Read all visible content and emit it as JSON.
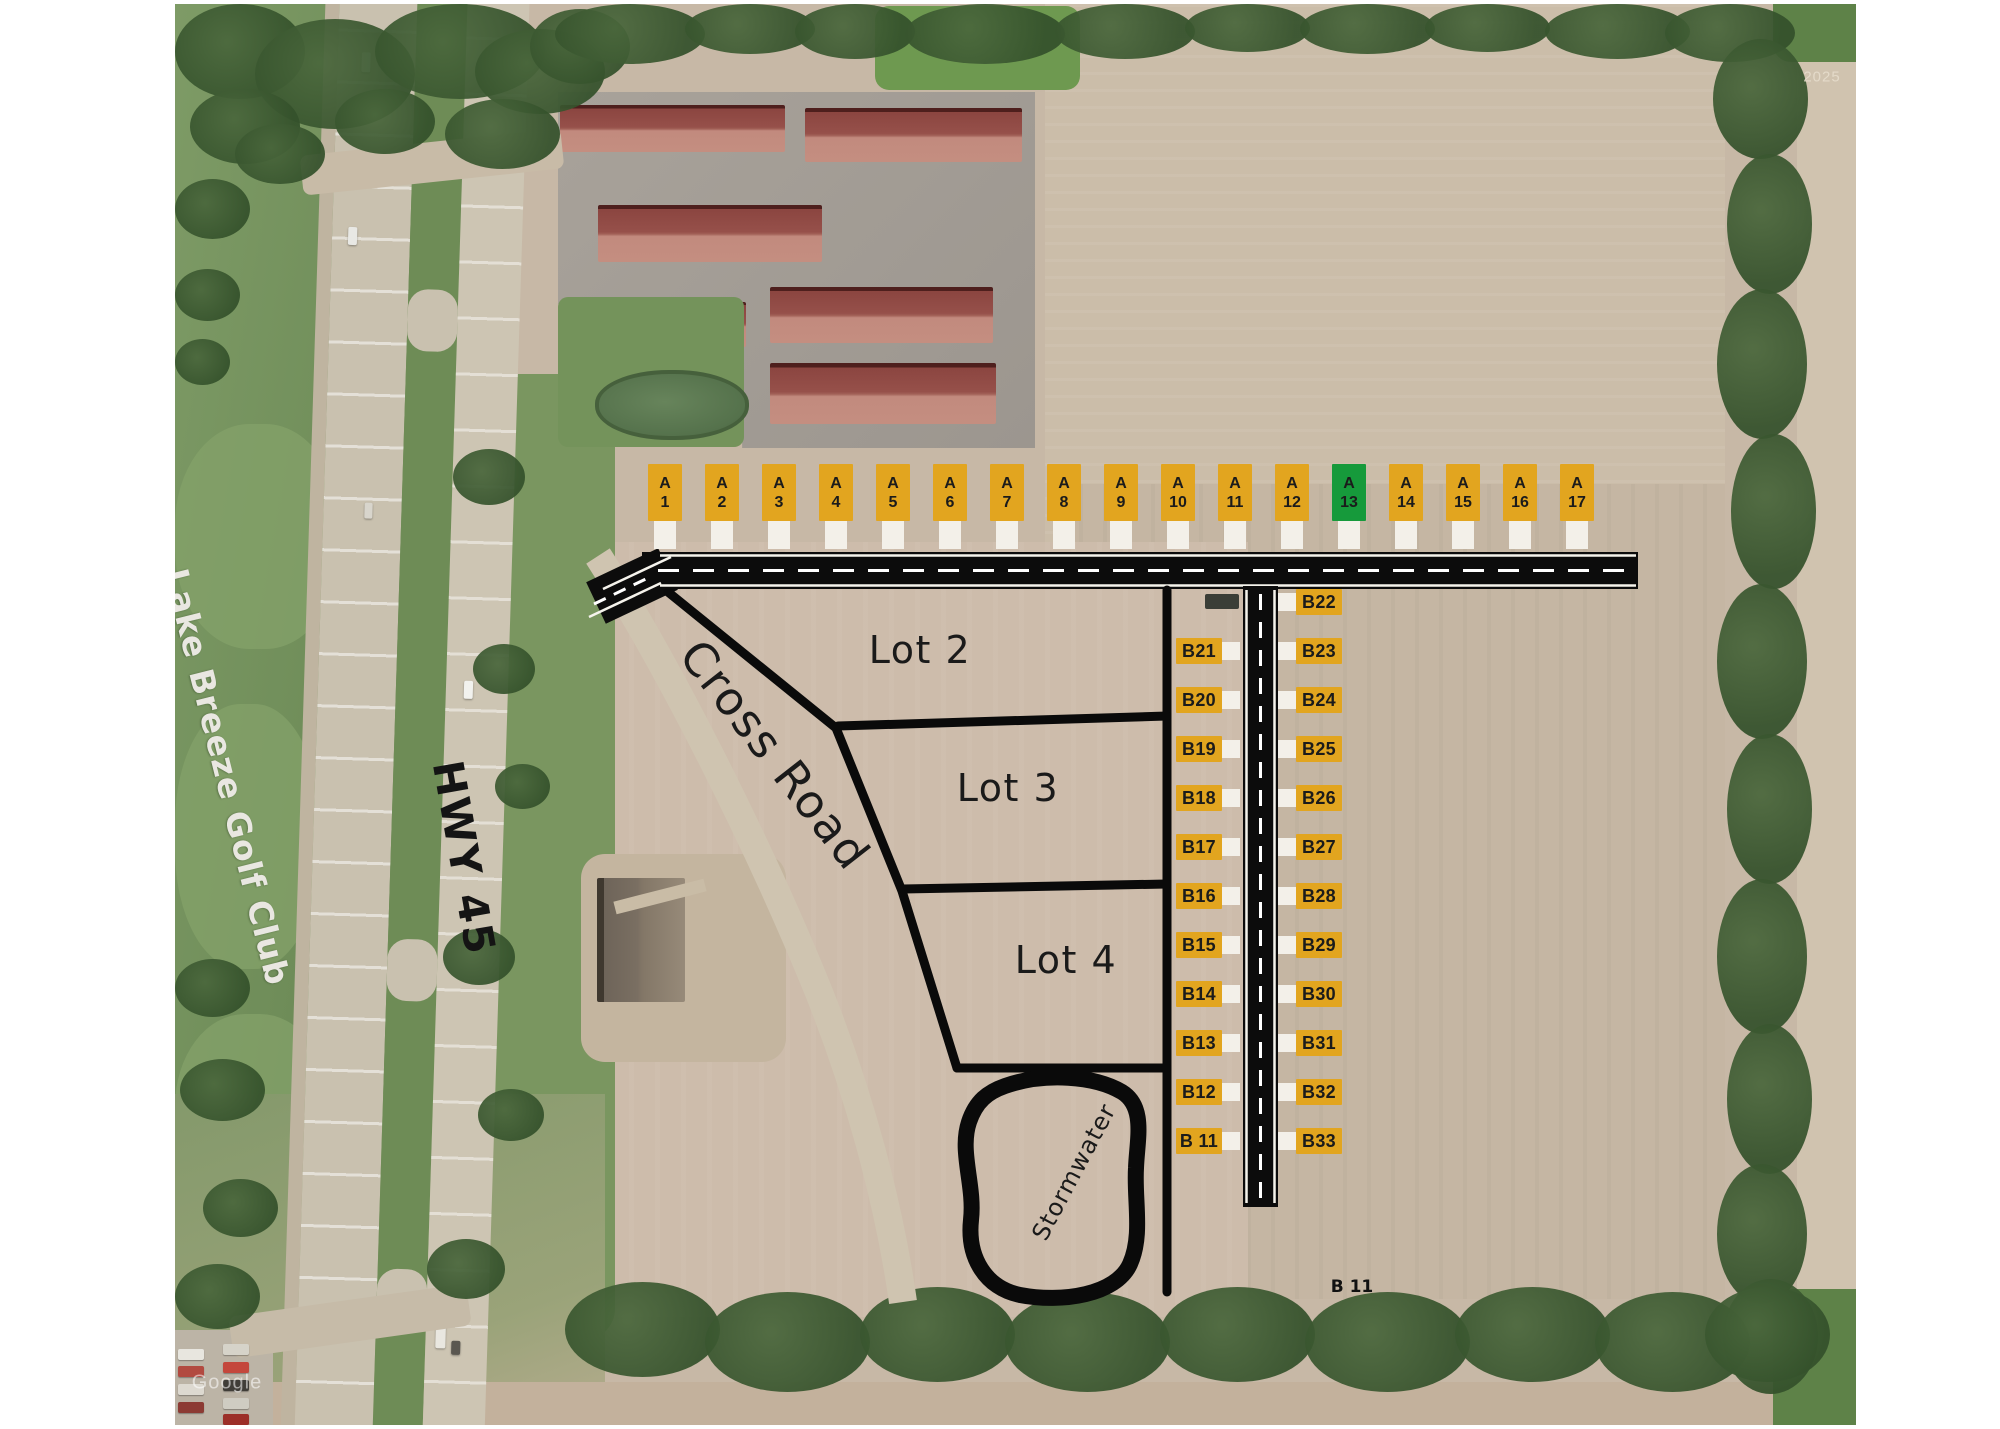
{
  "labels": {
    "lot2": "Lot 2",
    "lot3": "Lot 3",
    "lot4": "Lot 4",
    "stormwater": "Stormwater",
    "cross_road": "Cross Road",
    "highway": "HWY 45",
    "golf_club": "Lake Breeze Golf Club",
    "stray_b11": "B 11",
    "watermark_year": "2025",
    "watermark_brand": "Google"
  },
  "colors": {
    "marker_gold": "#E2A51F",
    "marker_green": "#169A3B",
    "marker_text": "#1B1B1B",
    "tab_white": "#F3F0E9",
    "road_black": "#0C0C0C",
    "boundary_black": "#0A0A0A",
    "sold_marker_dark": "#3A3E37"
  },
  "markers_a": [
    {
      "row1": "A",
      "row2": "1",
      "color": "gold"
    },
    {
      "row1": "A",
      "row2": "2",
      "color": "gold"
    },
    {
      "row1": "A",
      "row2": "3",
      "color": "gold"
    },
    {
      "row1": "A",
      "row2": "4",
      "color": "gold"
    },
    {
      "row1": "A",
      "row2": "5",
      "color": "gold"
    },
    {
      "row1": "A",
      "row2": "6",
      "color": "gold"
    },
    {
      "row1": "A",
      "row2": "7",
      "color": "gold"
    },
    {
      "row1": "A",
      "row2": "8",
      "color": "gold"
    },
    {
      "row1": "A",
      "row2": "9",
      "color": "gold"
    },
    {
      "row1": "A",
      "row2": "10",
      "color": "gold"
    },
    {
      "row1": "A",
      "row2": "11",
      "color": "gold"
    },
    {
      "row1": "A",
      "row2": "12",
      "color": "gold"
    },
    {
      "row1": "A",
      "row2": "13",
      "color": "green"
    },
    {
      "row1": "A",
      "row2": "14",
      "color": "gold"
    },
    {
      "row1": "A",
      "row2": "15",
      "color": "gold"
    },
    {
      "row1": "A",
      "row2": "16",
      "color": "gold"
    },
    {
      "row1": "A",
      "row2": "17",
      "color": "gold"
    }
  ],
  "markers_b_left": [
    "B21",
    "B20",
    "B19",
    "B18",
    "B17",
    "B16",
    "B15",
    "B14",
    "B13",
    "B12",
    "B 11"
  ],
  "markers_b_right": [
    "B22",
    "B23",
    "B24",
    "B25",
    "B26",
    "B27",
    "B28",
    "B29",
    "B30",
    "B31",
    "B32",
    "B33"
  ]
}
